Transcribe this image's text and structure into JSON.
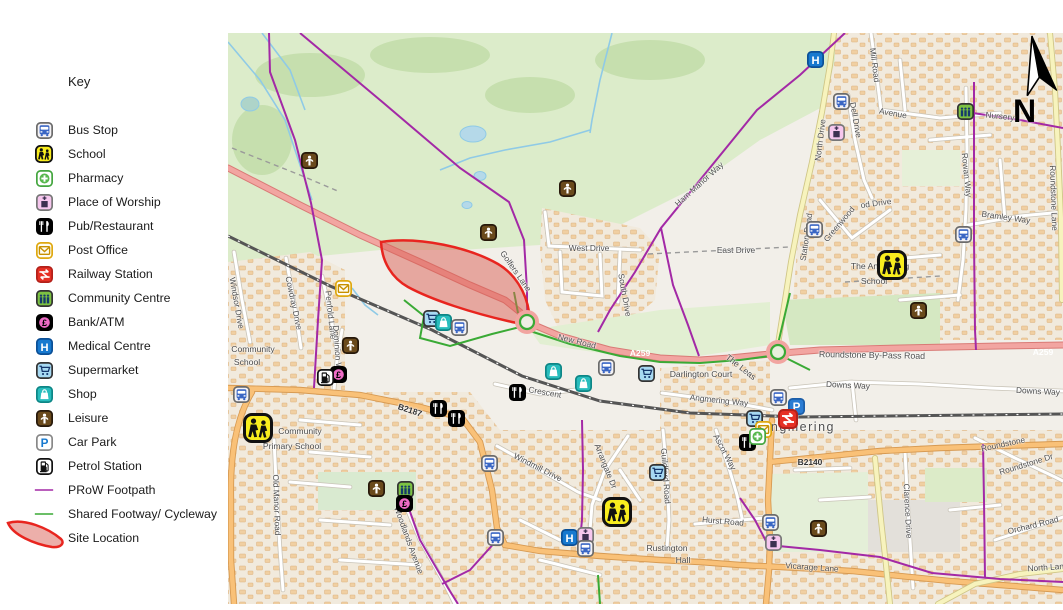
{
  "key": {
    "title": "Key",
    "items": [
      {
        "type": "bus",
        "label": "Bus Stop"
      },
      {
        "type": "school",
        "label": "School"
      },
      {
        "type": "pharmacy",
        "label": "Pharmacy"
      },
      {
        "type": "worship",
        "label": "Place of Worship"
      },
      {
        "type": "pub",
        "label": "Pub/Restaurant"
      },
      {
        "type": "post",
        "label": "Post Office"
      },
      {
        "type": "rail",
        "label": "Railway Station"
      },
      {
        "type": "community",
        "label": "Community Centre"
      },
      {
        "type": "bank",
        "label": "Bank/ATM"
      },
      {
        "type": "medical",
        "label": "Medical Centre"
      },
      {
        "type": "supermarket",
        "label": "Supermarket"
      },
      {
        "type": "shop",
        "label": "Shop"
      },
      {
        "type": "leisure",
        "label": "Leisure"
      },
      {
        "type": "carpark",
        "label": "Car Park"
      },
      {
        "type": "petrol",
        "label": "Petrol Station"
      },
      {
        "type": "prow",
        "label": "PRoW  Footpath"
      },
      {
        "type": "cycleway",
        "label": "Shared Footway/ Cycleway"
      },
      {
        "type": "site",
        "label": "Site Location"
      }
    ]
  },
  "map": {
    "north_label": "N",
    "colors": {
      "prow": "#a329a6",
      "cycleway": "#3aaa35",
      "site_stroke": "#e8251f",
      "site_fill": "rgba(217,95,86,0.5)",
      "a_road_fill": "#f2a5a1"
    },
    "labels": [
      {
        "t": "Community",
        "x": 253,
        "y": 349,
        "c": "pl"
      },
      {
        "t": "School",
        "x": 247,
        "y": 362,
        "c": "pl"
      },
      {
        "t": "West Drive",
        "x": 589,
        "y": 248
      },
      {
        "t": "East Drive",
        "x": 736,
        "y": 250
      },
      {
        "t": "Golfers Lane",
        "x": 516,
        "y": 271,
        "r": 55
      },
      {
        "t": "Ham Manor Way",
        "x": 699,
        "y": 184,
        "r": -42
      },
      {
        "t": "Mill Road",
        "x": 875,
        "y": 65,
        "r": 83
      },
      {
        "t": "Avenue",
        "x": 893,
        "y": 113,
        "r": 10
      },
      {
        "t": "Dell Drive",
        "x": 856,
        "y": 120,
        "r": 80
      },
      {
        "t": "North Drive",
        "x": 820,
        "y": 140,
        "r": -83
      },
      {
        "t": "Station Road",
        "x": 806,
        "y": 237,
        "r": -82
      },
      {
        "t": "Greenwood",
        "x": 839,
        "y": 224,
        "r": -50
      },
      {
        "t": "od Drive",
        "x": 876,
        "y": 203,
        "r": -8
      },
      {
        "t": "Rowan Way",
        "x": 967,
        "y": 175,
        "r": 84
      },
      {
        "t": "Bramley Way",
        "x": 1006,
        "y": 217,
        "r": 8
      },
      {
        "t": "Roundstone Lane",
        "x": 1054,
        "y": 198,
        "r": 88
      },
      {
        "t": "Nursery",
        "x": 1000,
        "y": 116,
        "r": 6
      },
      {
        "t": "New Road",
        "x": 577,
        "y": 341,
        "r": 14
      },
      {
        "t": "Roundstone By-Pass Road",
        "x": 872,
        "y": 355,
        "r": 1,
        "s": 8.8
      },
      {
        "t": "Downs Way",
        "x": 848,
        "y": 385,
        "r": 3
      },
      {
        "t": "Downs Way",
        "x": 1038,
        "y": 391,
        "r": 3
      },
      {
        "t": "Angmering Way",
        "x": 719,
        "y": 400,
        "r": 6
      },
      {
        "t": "The Leas",
        "x": 741,
        "y": 367,
        "r": 38,
        "c": "pl"
      },
      {
        "t": "Darlington Court",
        "x": 701,
        "y": 374,
        "c": "pl"
      },
      {
        "t": "South Drive",
        "x": 625,
        "y": 295,
        "r": 80
      },
      {
        "t": "Angmering",
        "x": 798,
        "y": 427,
        "c": "town"
      },
      {
        "t": "B2140",
        "x": 810,
        "y": 462,
        "c": "br"
      },
      {
        "t": "B2187",
        "x": 410,
        "y": 410,
        "r": 18,
        "c": "br"
      },
      {
        "t": "Windmill Drive",
        "x": 538,
        "y": 467,
        "r": 27
      },
      {
        "t": "Arrangate Dr",
        "x": 606,
        "y": 466,
        "r": 68
      },
      {
        "t": "Guildford Road",
        "x": 666,
        "y": 476,
        "r": 86
      },
      {
        "t": "Ascot Way",
        "x": 725,
        "y": 452,
        "r": 62
      },
      {
        "t": "Hurst Road",
        "x": 723,
        "y": 521,
        "r": 5
      },
      {
        "t": "Rustington",
        "x": 667,
        "y": 548,
        "c": "pl"
      },
      {
        "t": "Hall",
        "x": 683,
        "y": 560,
        "c": "pl"
      },
      {
        "t": "Vicarage Lane",
        "x": 812,
        "y": 567,
        "r": 4
      },
      {
        "t": "Clarence Drive",
        "x": 908,
        "y": 511,
        "r": 87
      },
      {
        "t": "Roundstone",
        "x": 1003,
        "y": 444,
        "r": -12
      },
      {
        "t": "Roundstone Dr",
        "x": 1026,
        "y": 464,
        "r": -17
      },
      {
        "t": "Orchard Road",
        "x": 1033,
        "y": 525,
        "r": -14
      },
      {
        "t": "North Lane",
        "x": 1048,
        "y": 567,
        "r": -4
      },
      {
        "t": "Windsor Drive",
        "x": 237,
        "y": 303,
        "r": 80
      },
      {
        "t": "Cowdray Drive",
        "x": 294,
        "y": 303,
        "r": 78
      },
      {
        "t": "Penfold Lane",
        "x": 331,
        "y": 315,
        "r": 84
      },
      {
        "t": "Dominion Way",
        "x": 338,
        "y": 352,
        "r": 86
      },
      {
        "t": "Old Manor Road",
        "x": 277,
        "y": 505,
        "r": 88
      },
      {
        "t": "Woodlands Avenue",
        "x": 409,
        "y": 540,
        "r": 70
      },
      {
        "t": "Crescent",
        "x": 545,
        "y": 392,
        "r": 10
      },
      {
        "t": "Community",
        "x": 300,
        "y": 431,
        "c": "pl"
      },
      {
        "t": "Primary School",
        "x": 292,
        "y": 446,
        "c": "pl"
      },
      {
        "t": "The Angmering",
        "x": 880,
        "y": 266,
        "c": "pl"
      },
      {
        "t": "School",
        "x": 874,
        "y": 281,
        "c": "pl"
      },
      {
        "t": "A259",
        "x": 640,
        "y": 353,
        "c": "ar"
      },
      {
        "t": "A259",
        "x": 1043,
        "y": 352,
        "c": "ar"
      }
    ],
    "markers": [
      {
        "t": "medical",
        "x": 815,
        "y": 59
      },
      {
        "t": "bus",
        "x": 841,
        "y": 101
      },
      {
        "t": "worship",
        "x": 836,
        "y": 132
      },
      {
        "t": "community",
        "x": 965,
        "y": 111
      },
      {
        "t": "bus",
        "x": 963,
        "y": 234
      },
      {
        "t": "bus",
        "x": 814,
        "y": 229
      },
      {
        "t": "school",
        "x": 892,
        "y": 265,
        "s": 30
      },
      {
        "t": "leisure",
        "x": 918,
        "y": 310
      },
      {
        "t": "leisure",
        "x": 309,
        "y": 160
      },
      {
        "t": "leisure",
        "x": 567,
        "y": 188
      },
      {
        "t": "leisure",
        "x": 488,
        "y": 232
      },
      {
        "t": "post",
        "x": 343,
        "y": 288
      },
      {
        "t": "supermarket",
        "x": 431,
        "y": 318
      },
      {
        "t": "shop",
        "x": 443,
        "y": 322
      },
      {
        "t": "bus",
        "x": 459,
        "y": 327
      },
      {
        "t": "leisure",
        "x": 350,
        "y": 345
      },
      {
        "t": "bank",
        "x": 338,
        "y": 374
      },
      {
        "t": "petrol",
        "x": 325,
        "y": 377
      },
      {
        "t": "bus",
        "x": 241,
        "y": 394
      },
      {
        "t": "school",
        "x": 258,
        "y": 428,
        "s": 30
      },
      {
        "t": "pub",
        "x": 438,
        "y": 408
      },
      {
        "t": "pub",
        "x": 456,
        "y": 418
      },
      {
        "t": "pub",
        "x": 517,
        "y": 392
      },
      {
        "t": "shop",
        "x": 553,
        "y": 371
      },
      {
        "t": "shop",
        "x": 583,
        "y": 383
      },
      {
        "t": "bus",
        "x": 606,
        "y": 367
      },
      {
        "t": "supermarket",
        "x": 646,
        "y": 373
      },
      {
        "t": "leisure",
        "x": 376,
        "y": 488
      },
      {
        "t": "community",
        "x": 405,
        "y": 489
      },
      {
        "t": "bank",
        "x": 404,
        "y": 503
      },
      {
        "t": "bus",
        "x": 489,
        "y": 463
      },
      {
        "t": "supermarket",
        "x": 657,
        "y": 472
      },
      {
        "t": "school",
        "x": 617,
        "y": 512,
        "s": 30
      },
      {
        "t": "medical",
        "x": 569,
        "y": 537
      },
      {
        "t": "worship",
        "x": 585,
        "y": 535
      },
      {
        "t": "bus",
        "x": 585,
        "y": 548
      },
      {
        "t": "bus",
        "x": 495,
        "y": 537
      },
      {
        "t": "bus",
        "x": 770,
        "y": 522
      },
      {
        "t": "worship",
        "x": 773,
        "y": 542
      },
      {
        "t": "leisure",
        "x": 818,
        "y": 528
      },
      {
        "t": "pub",
        "x": 747,
        "y": 442
      },
      {
        "t": "supermarket",
        "x": 754,
        "y": 418
      },
      {
        "t": "post",
        "x": 763,
        "y": 429
      },
      {
        "t": "pharmacy",
        "x": 757,
        "y": 436
      },
      {
        "t": "bus",
        "x": 778,
        "y": 397
      },
      {
        "t": "carpark",
        "x": 796,
        "y": 406
      },
      {
        "t": "rail",
        "x": 788,
        "y": 419,
        "s": 20
      }
    ]
  }
}
